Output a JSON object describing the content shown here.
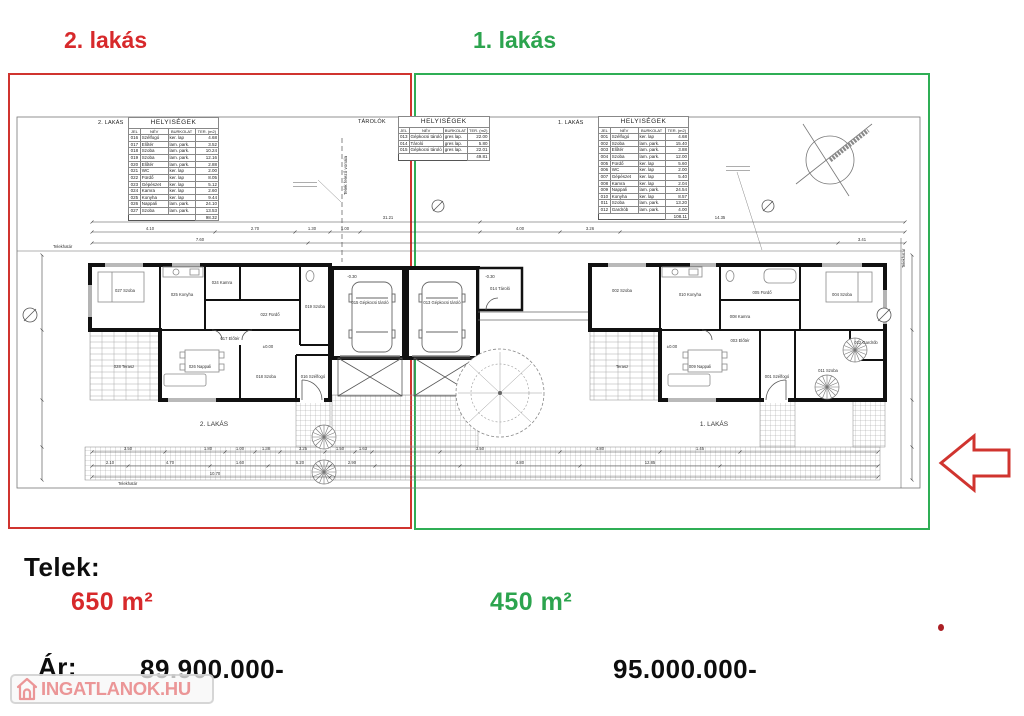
{
  "header": {
    "left_label": "2. lakás",
    "right_label": "1. lakás"
  },
  "colors": {
    "red": "#d7292b",
    "green": "#2ca44e"
  },
  "tables": {
    "left": {
      "unit_label": "2. LAKÁS",
      "title": "HELYISÉGEK",
      "columns": [
        "JEL",
        "NÉV",
        "BURKOLAT",
        "TER. (m2)"
      ],
      "rows": [
        [
          "016",
          "Szélfogó",
          "ker. lap",
          "4.68"
        ],
        [
          "017",
          "Előtér",
          "lam. park.",
          "3.52"
        ],
        [
          "018",
          "Szoba",
          "lam. park.",
          "10.24"
        ],
        [
          "019",
          "Szoba",
          "lam. park.",
          "12.16"
        ],
        [
          "020",
          "Előtér",
          "lam. park.",
          "2.88"
        ],
        [
          "021",
          "WC",
          "ker. lap",
          "2.00"
        ],
        [
          "022",
          "Fürdő",
          "ker. lap",
          "8.05"
        ],
        [
          "023",
          "Gépészet",
          "ker. lap",
          "5.12"
        ],
        [
          "024",
          "Kamra",
          "ker. lap",
          "2.60"
        ],
        [
          "025",
          "Konyha",
          "ker. lap",
          "9.44"
        ],
        [
          "026",
          "Nappali",
          "lam. park.",
          "24.10"
        ],
        [
          "027",
          "Szoba",
          "lam. park.",
          "13.53"
        ]
      ],
      "total": "98.32"
    },
    "middle": {
      "unit_label": "TÁROLÓK",
      "title": "HELYISÉGEK",
      "columns": [
        "JEL",
        "NÉV",
        "BURKOLAT",
        "TER. (m2)"
      ],
      "rows": [
        [
          "013",
          "Gépkocsi tároló",
          "gres lap.",
          "22.00"
        ],
        [
          "014",
          "Tároló",
          "gres lap.",
          "5.80"
        ],
        [
          "015",
          "Gépkocsi tároló",
          "gres lap.",
          "22.01"
        ]
      ],
      "total": "49.81"
    },
    "right": {
      "unit_label": "1. LAKÁS",
      "title": "HELYISÉGEK",
      "columns": [
        "JEL",
        "NÉV",
        "BURKOLAT",
        "TER. (m2)"
      ],
      "rows": [
        [
          "001",
          "Szélfogó",
          "ker. lap",
          "4.68"
        ],
        [
          "002",
          "Szoba",
          "lam. park.",
          "15.40"
        ],
        [
          "003",
          "Előtér",
          "lam. park.",
          "3.88"
        ],
        [
          "004",
          "Szoba",
          "lam. park.",
          "12.00"
        ],
        [
          "005",
          "Fürdő",
          "ker. lap",
          "5.60"
        ],
        [
          "006",
          "WC",
          "ker. lap",
          "2.00"
        ],
        [
          "007",
          "Gépészet",
          "ker. lap",
          "5.40"
        ],
        [
          "008",
          "Kamra",
          "ker. lap",
          "2.04"
        ],
        [
          "009",
          "Nappali",
          "lam. park.",
          "24.54"
        ],
        [
          "010",
          "Konyha",
          "ker. lap",
          "8.57"
        ],
        [
          "011",
          "Szoba",
          "lam. park.",
          "13.20"
        ],
        [
          "012",
          "Gardrób",
          "lam. park.",
          "4.00"
        ]
      ],
      "total": "108.11"
    }
  },
  "plan": {
    "unit2_label": "2. LAKÁS",
    "unit1_label": "1. LAKÁS",
    "boundary_left": "Telekhatár",
    "boundary_bottom": "Telekhatár",
    "boundary_right": "Telekhatár",
    "divider_label": "Telek felező vonala",
    "rooms2": [
      "027 Szoba",
      "025 Konyha",
      "024 Kamra",
      "022 Fürdő",
      "019 Szoba",
      "017 Előtér",
      "026 Nappali",
      "016 Szélfogó",
      "018 Szoba",
      "028 Terasz"
    ],
    "rooms1": [
      "002 Szoba",
      "010 Konyha",
      "008 Kamra",
      "005 Fürdő",
      "004 Szoba",
      "003 Előtér",
      "009 Nappali",
      "001 Szélfogó",
      "011 Szoba",
      "Terasz",
      "012 Gardrób"
    ],
    "garage": [
      "015 Gépkocsi tároló",
      "013 Gépkocsi tároló",
      "014 Tároló"
    ],
    "levels": [
      "±0.00",
      "±0.00",
      "-0.30",
      "-0.30"
    ],
    "dims_a": [
      "31.21",
      "14.35"
    ],
    "dims_b": [
      "4.10",
      "2.70",
      "1.30",
      "1.00",
      "4.00",
      "3.26"
    ],
    "dims_c": [
      "7.60",
      "3.41"
    ],
    "dims_d": [
      "3.50",
      "1.80",
      "1.00",
      "1.38",
      "3.25",
      "1.50",
      "1.63",
      "3.50",
      "4.80",
      "1.45"
    ],
    "dims_e": [
      "2.10",
      "4.70",
      "1.60",
      "5.20",
      "2.90",
      "4.80",
      "12.85"
    ],
    "dims_f": [
      "10.70"
    ]
  },
  "footer": {
    "telek_label": "Telek:",
    "area_left": "650 m²",
    "area_right": "450 m²",
    "price_label": "Ár:",
    "price_left": "89.900.000-",
    "price_right": "95.000.000-"
  },
  "watermark": {
    "text": "INGATLANOK.HU"
  }
}
